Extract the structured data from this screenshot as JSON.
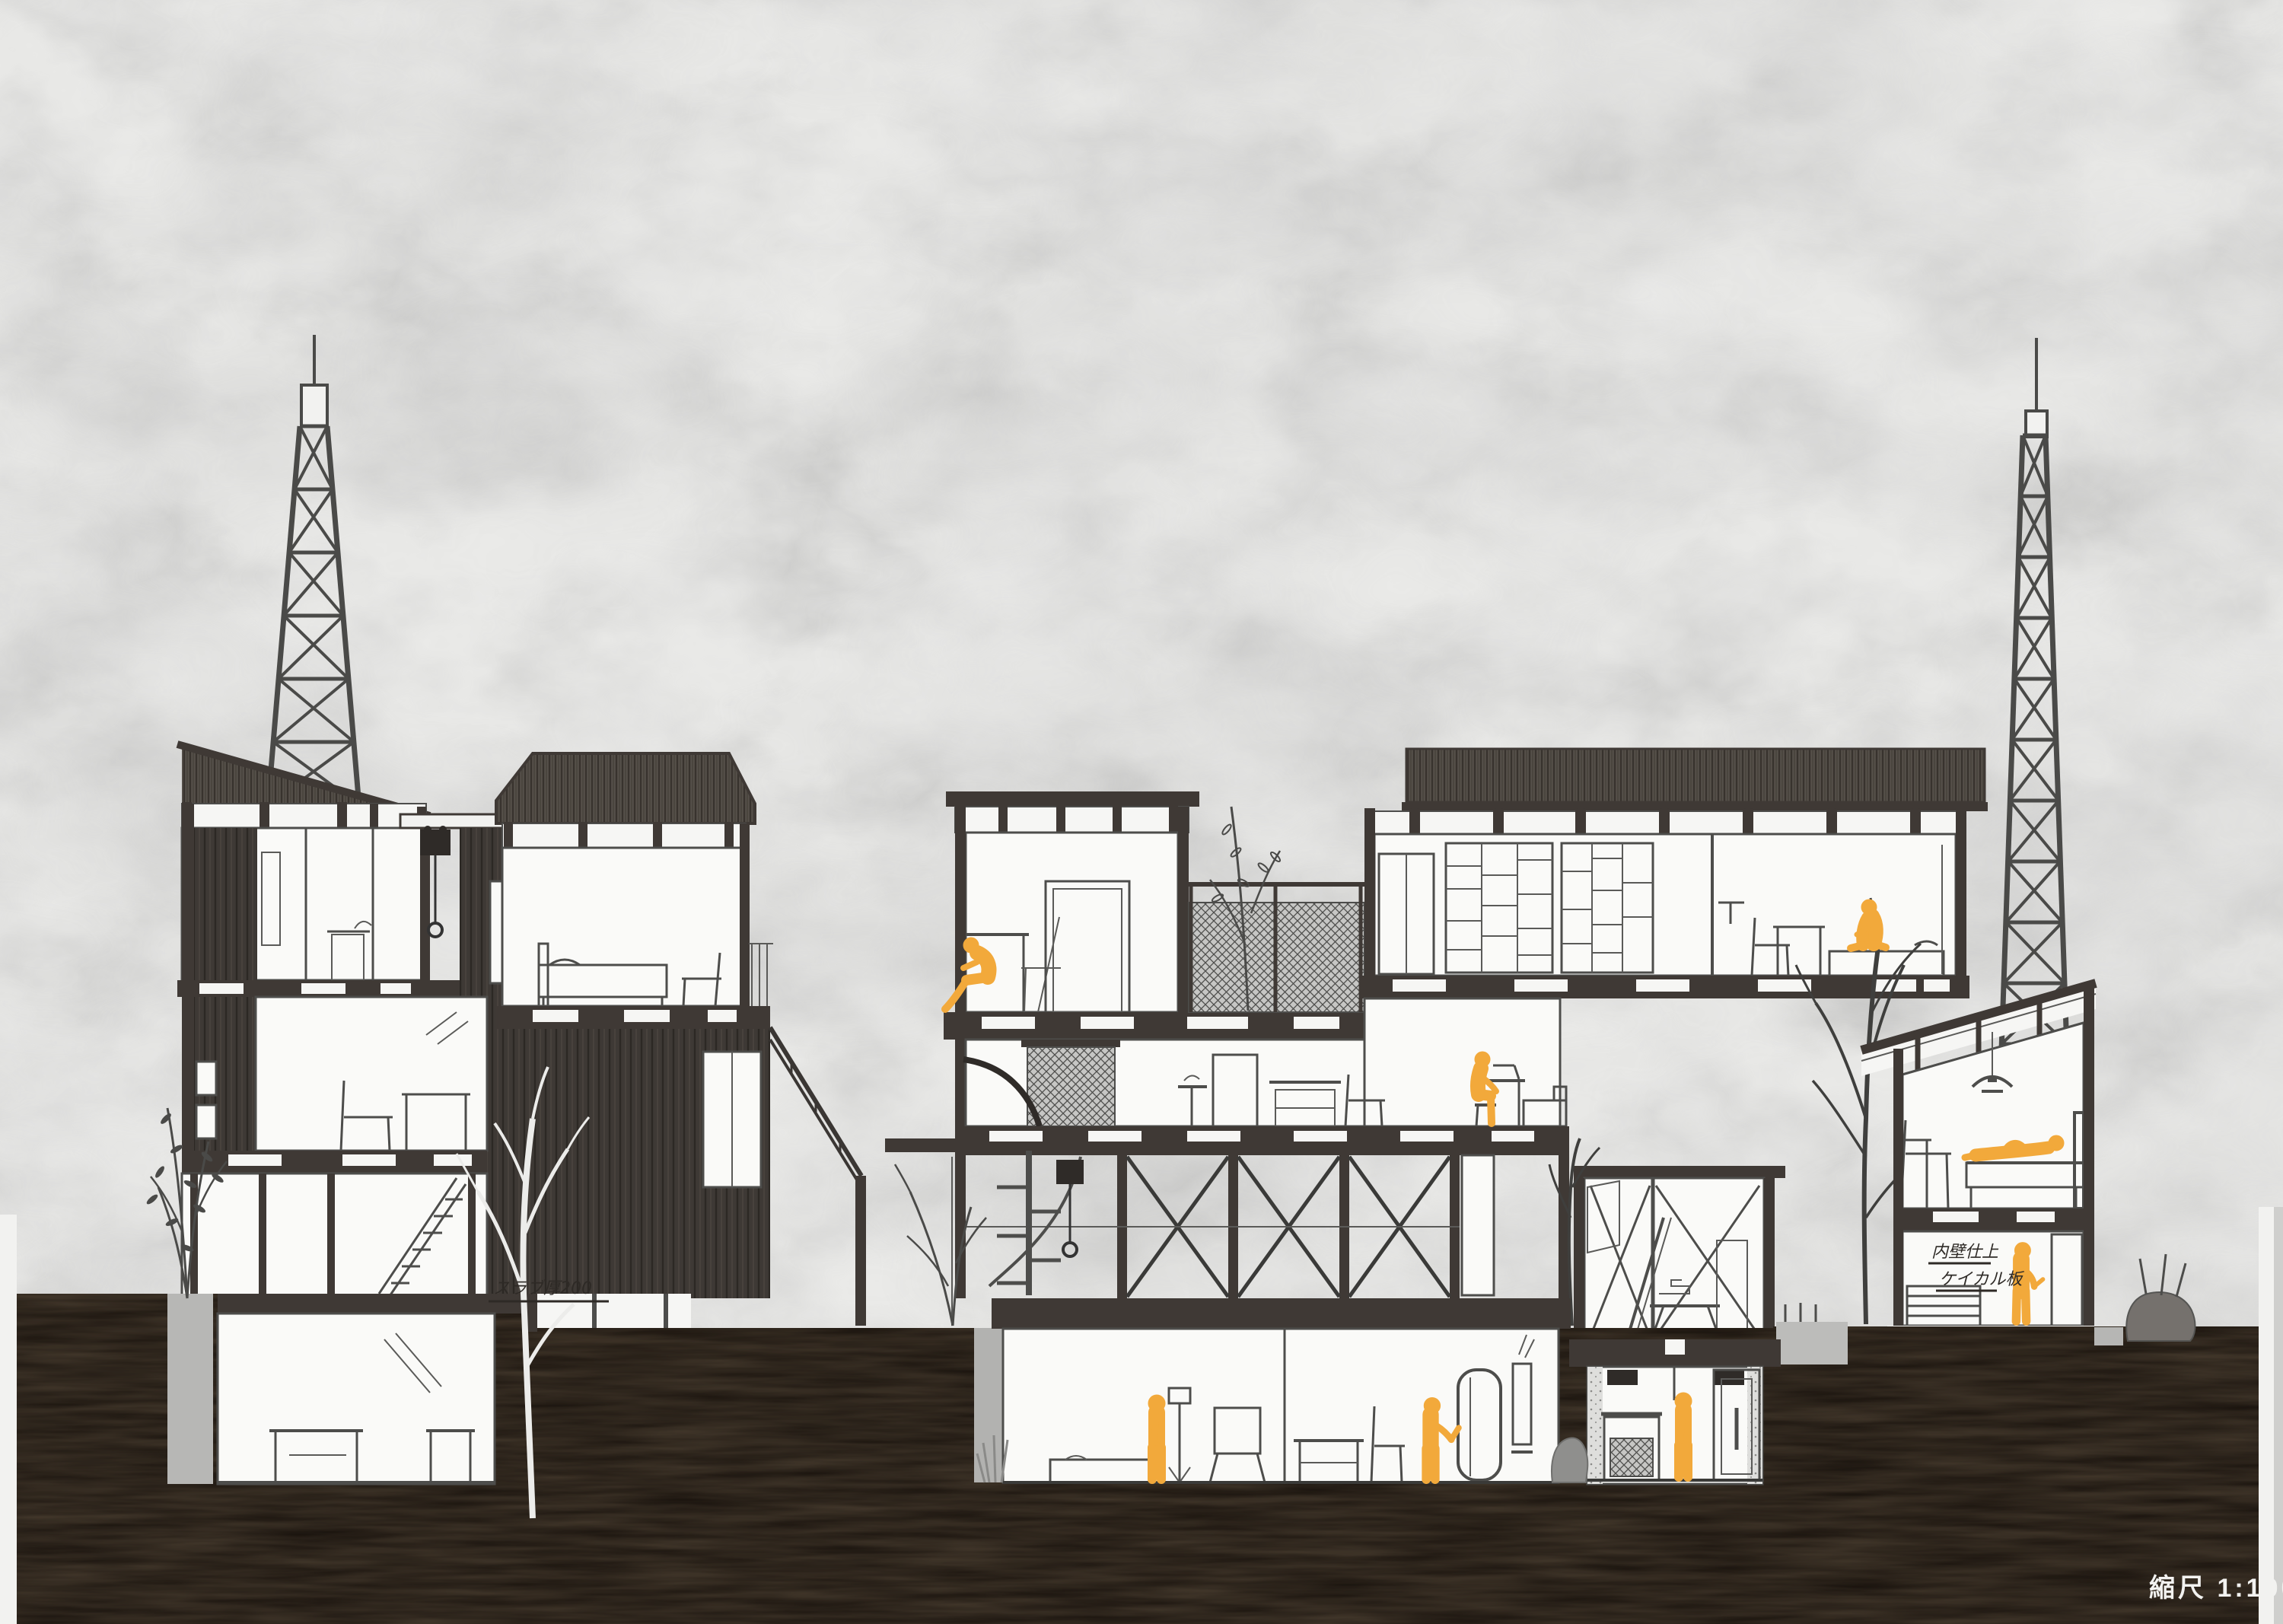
{
  "page": {
    "title": "Architectural longitudinal section drawing",
    "scale_label": "縮尺 1:100",
    "scale_value": "1:100"
  },
  "annotations": {
    "slab_thickness_note": "スラブ厚200",
    "wall_finish_note_line1": "内壁仕上",
    "wall_finish_note_line2": "ケイカル板"
  },
  "colors": {
    "figure": "#F2A93B",
    "ground": "#17110C",
    "sky": "#EAEAE8",
    "structure": "#3F3935",
    "roof": "#55504A",
    "retaining_gray": "#B7B7B5",
    "pencil": "#4D4D4B",
    "paper_white": "#FAFAF8"
  },
  "figures": [
    {
      "id": "figure-1",
      "pose": "seated-at-desk",
      "location": "middle tower upper room"
    },
    {
      "id": "figure-2",
      "pose": "seated-on-stool",
      "location": "middle building mid-level counter"
    },
    {
      "id": "figure-3",
      "pose": "seated-on-bed",
      "location": "upper block bedroom right"
    },
    {
      "id": "figure-4",
      "pose": "standing",
      "location": "middle basement workshop"
    },
    {
      "id": "figure-5",
      "pose": "standing-gesturing",
      "location": "middle basement bathroom"
    },
    {
      "id": "figure-6",
      "pose": "standing",
      "location": "small annex basement"
    },
    {
      "id": "figure-7",
      "pose": "lying-on-bed",
      "location": "right house bedroom"
    },
    {
      "id": "figure-8",
      "pose": "standing-reading",
      "location": "right house lower room"
    }
  ],
  "structures": [
    {
      "id": "left-residence-cluster",
      "features": [
        "shed roof unit",
        "gabled bedroom unit",
        "dark plank siding",
        "basement room",
        "exterior stairs",
        "monorail hoist"
      ]
    },
    {
      "id": "middle-workshop-building",
      "features": [
        "flat-roof tower unit",
        "terrace with mesh guardrail",
        "corrugated-roof upper block",
        "shelving wall",
        "X-braced frame level",
        "spiral stair",
        "sunken workshop and bathroom"
      ]
    },
    {
      "id": "small-annex-building",
      "features": [
        "braced upper room",
        "ladder",
        "basement with door and machine"
      ]
    },
    {
      "id": "right-house",
      "features": [
        "mono-pitch roof",
        "pendant lamp",
        "bed",
        "lower room with shelf"
      ]
    }
  ],
  "towers": [
    {
      "id": "left-lattice-tower"
    },
    {
      "id": "right-lattice-tower"
    }
  ],
  "vegetation": [
    {
      "id": "left-leafy-plant"
    },
    {
      "id": "white-tree-silhouette"
    },
    {
      "id": "middle-bare-shrub"
    },
    {
      "id": "terrace-sprig"
    },
    {
      "id": "small-bare-tree"
    },
    {
      "id": "large-bare-tree"
    },
    {
      "id": "right-gray-shrub"
    },
    {
      "id": "well-grass"
    }
  ]
}
